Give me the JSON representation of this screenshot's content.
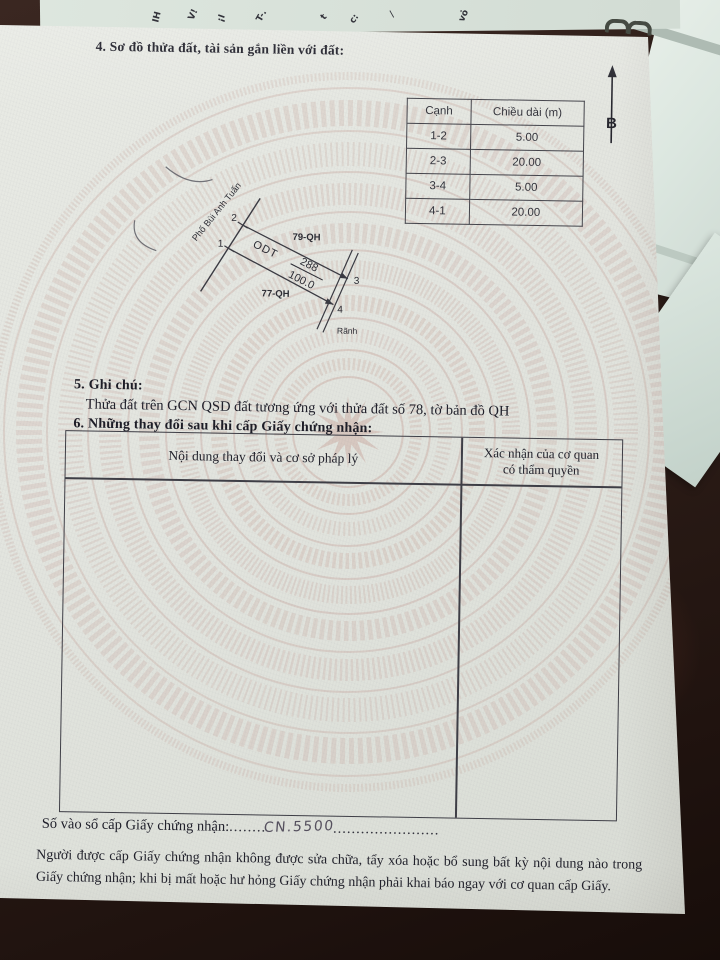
{
  "colors": {
    "paper": "#e3e5df",
    "drum_pattern": "#c9a8a0",
    "desk_wood": "#2e1f1a",
    "ink": "#24242e",
    "handwriting_ink": "#55505e",
    "background_papers": "#dde6de"
  },
  "doc": {
    "section4_title": "4. Sơ đồ thửa đất, tài sản gắn liền với đất:",
    "north_label": "B",
    "edge_table": {
      "headers": [
        "Cạnh",
        "Chiều dài (m)"
      ],
      "rows": [
        [
          "1-2",
          "5.00"
        ],
        [
          "2-3",
          "20.00"
        ],
        [
          "3-4",
          "5.00"
        ],
        [
          "4-1",
          "20.00"
        ]
      ]
    },
    "diagram": {
      "street_name": "Phố Bùi Anh Tuấn",
      "adjacent_parcel_top": "79-QH",
      "adjacent_parcel_bottom": "77-QH",
      "land_use_code": "ODT",
      "parcel_number": "288",
      "area": "100.0",
      "ditch_label": "Rãnh",
      "corner_1": "1",
      "corner_2": "2",
      "corner_3": "3",
      "corner_4": "4"
    },
    "section5_title": "5. Ghi chú:",
    "section5_note": "Thửa đất trên GCN QSD đất tương ứng với thửa đất số 78, tờ bản đồ QH",
    "section6_title": "6. Những thay đổi sau khi cấp Giấy chứng nhận:",
    "section6_table": {
      "col1_header": "Nội dung thay đổi và cơ sở pháp lý",
      "col2_header_line1": "Xác nhận của cơ quan",
      "col2_header_line2": "có thẩm quyền"
    },
    "registry_label": "Số vào sổ cấp Giấy chứng nhận:",
    "registry_dots_before": "........",
    "registry_number": "CN.5500",
    "registry_dots_after": ".......................",
    "footer_note": "Người được cấp Giấy chứng nhận không được sửa chữa, tẩy xóa hoặc bổ sung bất kỳ nội dung nào trong Giấy chứng nhận; khi bị mất hoặc hư hỏng Giấy chứng nhận phải khai báo ngay với cơ quan cấp Giấy.",
    "background_fragments": [
      "IH",
      "V!",
      "¡I",
      "T-.",
      "t",
      "c:",
      "⁄",
      "vỏ"
    ]
  }
}
